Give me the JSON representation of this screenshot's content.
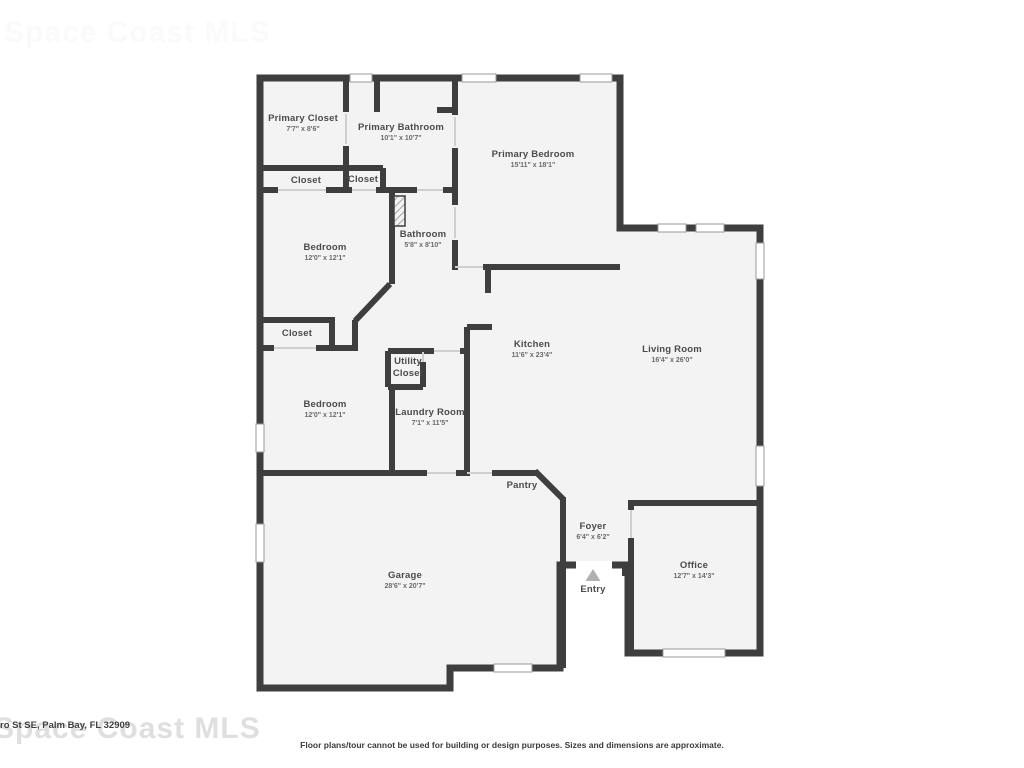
{
  "watermark": {
    "text": "Space Coast MLS"
  },
  "address_fragment": "ro St SE, Palm Bay, FL 32909",
  "disclaimer": "Floor plans/tour cannot be used for building or design purposes. Sizes and dimensions are approximate.",
  "colors": {
    "wall": "#3e3e3e",
    "floor": "#f3f3f3",
    "door_line": "#cfcfcf",
    "window_edge": "#9a9a9a",
    "entry_arrow": "#b0b0b0"
  },
  "rooms": [
    {
      "name": "Primary Closet",
      "dims": "7'7\" x 8'6\""
    },
    {
      "name": "Primary Bathroom",
      "dims": "10'1\" x 10'7\""
    },
    {
      "name": "Primary Bedroom",
      "dims": "15'11\" x 18'1\""
    },
    {
      "name": "Closet",
      "dims": ""
    },
    {
      "name": "Closet",
      "dims": ""
    },
    {
      "name": "Bedroom",
      "dims": "12'0\" x 12'1\""
    },
    {
      "name": "Bathroom",
      "dims": "5'8\" x 8'10\""
    },
    {
      "name": "Closet",
      "dims": ""
    },
    {
      "name": "Utility Closet",
      "dims": ""
    },
    {
      "name": "Bedroom",
      "dims": "12'0\" x 12'1\""
    },
    {
      "name": "Laundry Room",
      "dims": "7'1\" x 11'5\""
    },
    {
      "name": "Kitchen",
      "dims": "11'6\" x 23'4\""
    },
    {
      "name": "Living Room",
      "dims": "16'4\" x 26'0\""
    },
    {
      "name": "Pantry",
      "dims": ""
    },
    {
      "name": "Foyer",
      "dims": "6'4\" x 6'2\""
    },
    {
      "name": "Garage",
      "dims": "28'6\" x 20'7\""
    },
    {
      "name": "Office",
      "dims": "12'7\" x 14'3\""
    },
    {
      "name": "Entry",
      "dims": ""
    }
  ]
}
